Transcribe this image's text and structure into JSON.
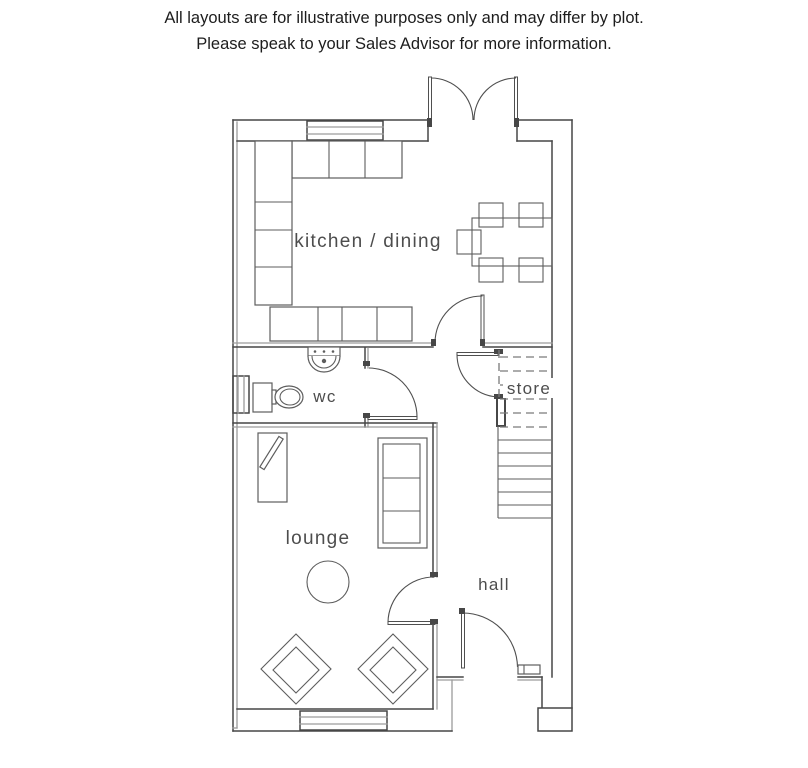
{
  "disclaimer": {
    "line1": "All layouts are for illustrative purposes only and may differ by plot.",
    "line2": "Please speak to your Sales Advisor for more information."
  },
  "floorplan": {
    "rooms": [
      {
        "id": "kitchen-dining",
        "label": "kitchen / dining"
      },
      {
        "id": "wc",
        "label": "wc"
      },
      {
        "id": "store",
        "label": "store"
      },
      {
        "id": "lounge",
        "label": "lounge"
      },
      {
        "id": "hall",
        "label": "hall"
      }
    ],
    "features": [
      "french-doors",
      "kitchen-window",
      "wc-window",
      "lounge-window",
      "staircase",
      "under-stairs-store",
      "front-door"
    ],
    "colors": {
      "wall": "#474747",
      "wall_light": "#9c9c9c",
      "furniture": "#5d5d5d",
      "label": "#4d4d4d",
      "dash": "#7a7a7a",
      "text": "#1d1d1d"
    }
  }
}
